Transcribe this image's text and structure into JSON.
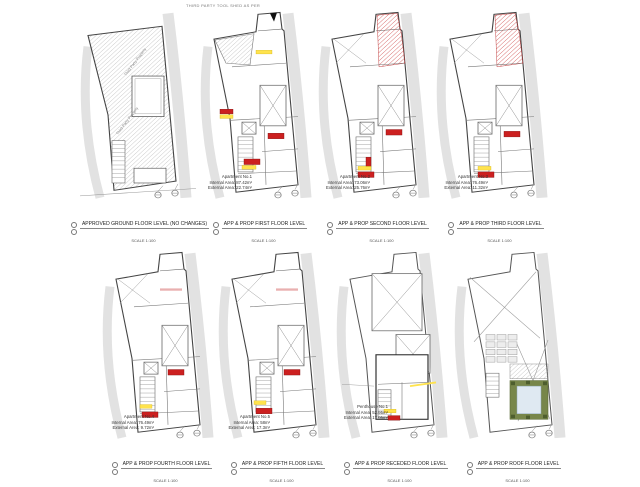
{
  "sheet": {
    "top_note": "THIRD PARTY TOOL SHED AS PER",
    "colors": {
      "line": "#555555",
      "band": "#e2e2e2",
      "hatch": "#aaaaaa",
      "accent_red": "#cc2020",
      "highlight_yellow": "#ffe34d",
      "roof_green": "#77864a",
      "bush_green": "#4e5e2e",
      "courtyard_blue": "#dfe9f2"
    }
  },
  "panels": [
    {
      "id": "ground",
      "type": "ground",
      "title": "APPROVED GROUND FLOOR LEVEL (NO CHANGES)",
      "scale": "SCALE 1:100",
      "rotated_labels": [
        "Third Party Property",
        "Third Party Property"
      ],
      "info": []
    },
    {
      "id": "first",
      "type": "typical",
      "variant": "first",
      "title": "APP & PROP FIRST FLOOR LEVEL",
      "scale": "SCALE 1:100",
      "info": [
        "Apartment No.1",
        "Internal Area: 87.42m²",
        "External Area: 22.74m²"
      ]
    },
    {
      "id": "second",
      "type": "typical",
      "variant": "redtop",
      "title": "APP & PROP SECOND FLOOR LEVEL",
      "scale": "SCALE 1:100",
      "info": [
        "Apartment No.2",
        "Internal Area: 73.06m²",
        "External Area: 25.76m²"
      ]
    },
    {
      "id": "third",
      "type": "typical",
      "variant": "redtop",
      "title": "APP & PROP THIRD FLOOR LEVEL",
      "scale": "SCALE 1:100",
      "info": [
        "Apartment No.3",
        "Internal Area: 76.49m²",
        "External Area: 11.32m²"
      ]
    },
    {
      "id": "fourth",
      "type": "typical",
      "variant": "upper",
      "title": "APP & PROP FOURTH FLOOR LEVEL",
      "scale": "SCALE 1:100",
      "info": [
        "Apartment No.4",
        "Internal Area: 76.49m²",
        "External Area: 9.72m²"
      ]
    },
    {
      "id": "fifth",
      "type": "typical",
      "variant": "upper",
      "title": "APP & PROP FIFTH FLOOR LEVEL",
      "scale": "SCALE 1:100",
      "info": [
        "Apartment No.5",
        "Internal Area: 58m²",
        "External Area: 17.3m²"
      ]
    },
    {
      "id": "receded",
      "type": "receded",
      "title": "APP & PROP RECEDED FLOOR LEVEL",
      "scale": "SCALE 1:100",
      "info": [
        "Penthouse No.1",
        "Internal Area: 52.95m²",
        "External Area: 17.05m²"
      ]
    },
    {
      "id": "roof",
      "type": "roof",
      "title": "APP & PROP ROOF FLOOR LEVEL",
      "scale": "SCALE 1:100",
      "info": []
    }
  ]
}
